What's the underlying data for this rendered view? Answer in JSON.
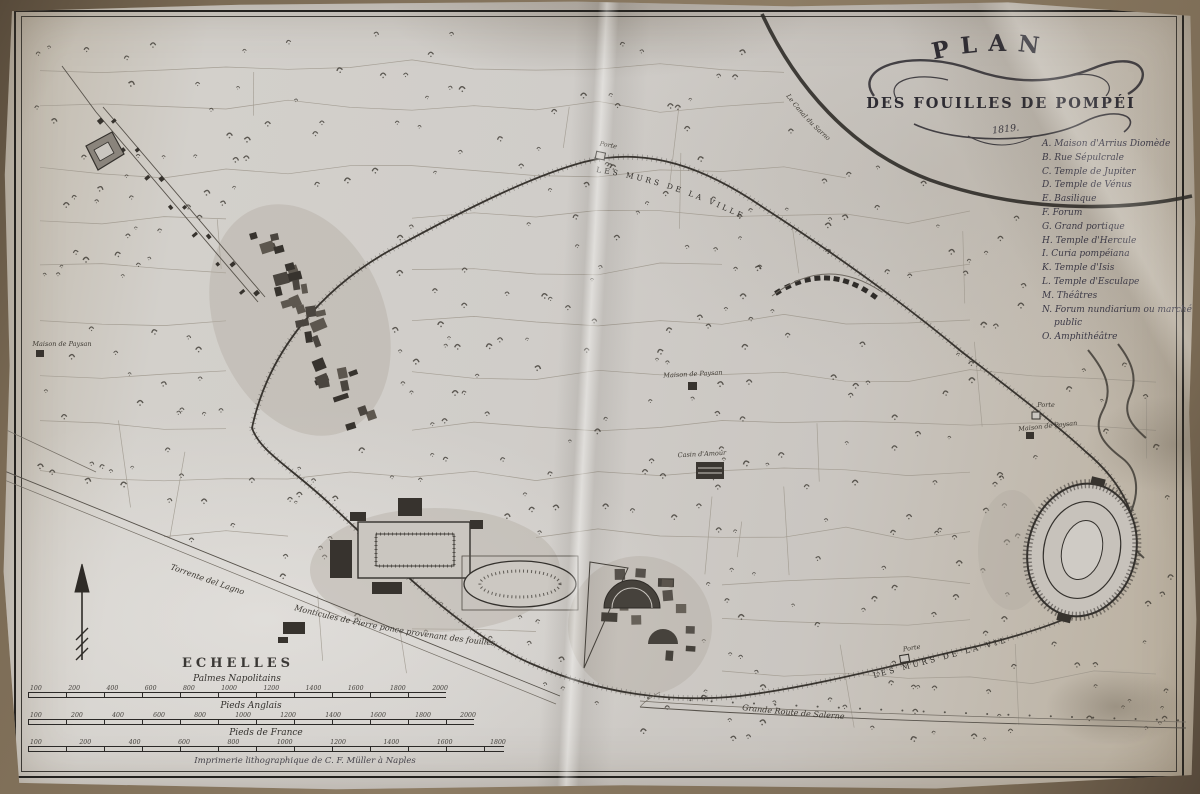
{
  "title": {
    "line1": "PLAN",
    "line2": "DES FOUILLES DE POMPÉI",
    "date": "1819."
  },
  "legend": {
    "items": [
      "A. Maison d'Arrius Diomède",
      "B. Rue Sépulcrale",
      "C. Temple de Jupiter",
      "D. Temple de Vénus",
      "E. Basilique",
      "F. Forum",
      "G. Grand portique",
      "H. Temple d'Hercule",
      "I. Curia pompéiana",
      "K. Temple d'Isis",
      "L. Temple d'Esculape",
      "M. Théâtres",
      "N. Forum nundiarium ou marché public",
      "O. Amphithéâtre"
    ]
  },
  "map_labels": {
    "walls_top": "LES MURS DE LA VILLE",
    "walls_bottom": "LES MURS DE LA VILLE",
    "canal": "Le Canal du Sarno",
    "route": "Grande Route de Salerne",
    "monticules": "Monticules de Pierre ponce provenant des fouilles",
    "torrente": "Torrente del Lagno",
    "maison_paysan_a": "Maison de Paysan",
    "maison_paysan_b": "Maison de Paysan",
    "maison_paysan_c": "Maison de Paysan",
    "casin": "Casin d'Amour",
    "porte_a": "Porte",
    "porte_b": "Porte",
    "porte_c": "Porte"
  },
  "scales": {
    "heading": "ECHELLES",
    "bars": [
      {
        "label": "Palmes Napolitains",
        "ticks": [
          "100",
          "200",
          "400",
          "600",
          "800",
          "1000",
          "1200",
          "1400",
          "1600",
          "1800",
          "2000"
        ]
      },
      {
        "label": "Pieds Anglais",
        "ticks": [
          "100",
          "200",
          "400",
          "600",
          "800",
          "1000",
          "1200",
          "1400",
          "1600",
          "1800",
          "2000"
        ]
      },
      {
        "label": "Pieds de France",
        "ticks": [
          "100",
          "200",
          "400",
          "600",
          "800",
          "1000",
          "1200",
          "1400",
          "1600",
          "1800"
        ]
      }
    ]
  },
  "imprint": "Imprimerie lithographique de C. F. Müller à Naples"
}
